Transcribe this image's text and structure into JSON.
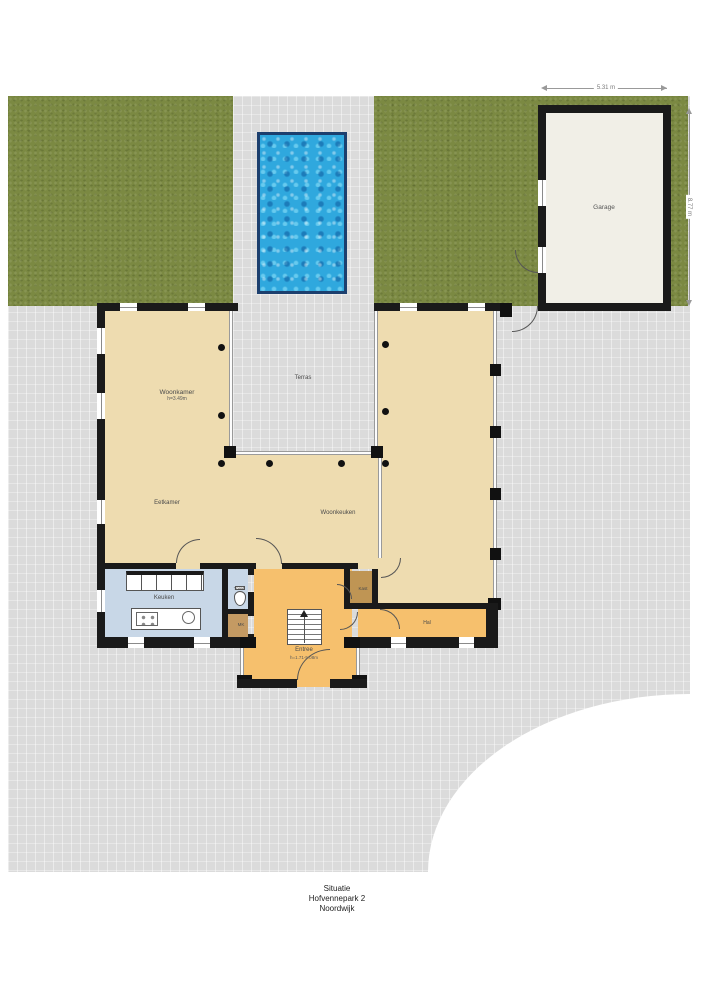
{
  "plan": {
    "rooms": {
      "garage": {
        "label": "Garage"
      },
      "woonkamer": {
        "label": "Woonkamer",
        "height": "h=3.49m"
      },
      "terras": {
        "label": "Terras"
      },
      "eetkamer": {
        "label": "Eetkamer"
      },
      "woonkeuken": {
        "label": "Woonkeuken"
      },
      "keuken": {
        "label": "Keuken"
      },
      "toilet": {
        "label": "Toilet"
      },
      "meterkast": {
        "label": "MK"
      },
      "kast": {
        "label": "Kast"
      },
      "entree": {
        "label": "Entree",
        "height": "h=1.71-5.08m"
      },
      "hal": {
        "label": "Hal"
      }
    },
    "dimensions": {
      "garage_width": "5.31 m",
      "garage_depth": "8.77 m"
    },
    "caption": {
      "line1": "Situatie",
      "line2": "Hofvennepark 2",
      "line3": "Noordwijk"
    },
    "colors": {
      "lawn": "#7b8942",
      "paving": "#dbdbdb",
      "pool_water": "#2fa8de",
      "pool_border": "#1c3f6e",
      "living_floor": "#eedcb0",
      "entry_floor": "#f6c06d",
      "kitchen_floor": "#c8d7e7",
      "closet_floor": "#c49a63",
      "garage_floor": "#f1efe7",
      "wall": "#1a1a1a"
    }
  }
}
